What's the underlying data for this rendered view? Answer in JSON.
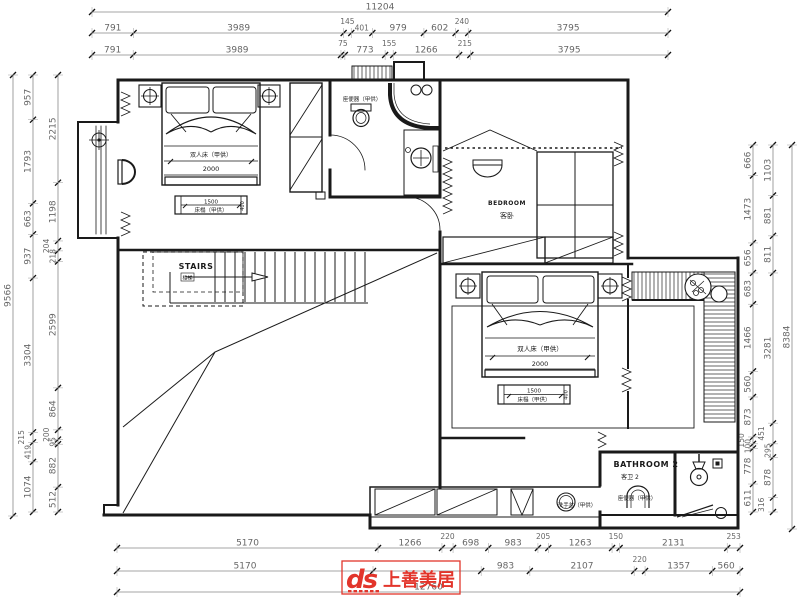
{
  "colors": {
    "logo_red": "#e2352b",
    "ink": "#1a1a1a",
    "dim_text": "#666666"
  },
  "logo": {
    "mark": "ds",
    "brand": "上善美居"
  },
  "labels": {
    "stairs_en": "STAIRS",
    "stairs_cn": "楼梯",
    "bedroom_en": "BEDROOM",
    "bedroom_cn": "客卧",
    "bathroom2_en": "BATHROOM 2",
    "bathroom2_cn": "客卫 2",
    "double_bed": "双人床（甲供）",
    "bed_width": "2000",
    "bench_len": "1500",
    "bench": "床榻（甲供）",
    "bench_depth": "400",
    "toilet": "座便器（甲供）",
    "basin": "洗手盆（甲供）"
  },
  "dims": {
    "top_total": [
      11204
    ],
    "top_row1": [
      791,
      3989,
      145,
      401,
      979,
      602,
      240,
      3795
    ],
    "top_row2": [
      791,
      3989,
      75,
      773,
      155,
      1266,
      215,
      3795
    ],
    "left_total": [
      9566
    ],
    "left_a": [
      957,
      1793,
      663,
      937,
      3304,
      215,
      419,
      1074
    ],
    "left_b": [
      2215,
      1198,
      204,
      218,
      2599,
      864,
      200,
      95,
      882,
      512
    ],
    "right_c": [
      666,
      1473,
      656,
      683,
      1466,
      560,
      873,
      150,
      100,
      778,
      611
    ],
    "right_d": [
      1103,
      881,
      811,
      3281,
      451,
      295,
      878,
      316
    ],
    "right_total": [
      8384
    ],
    "bottom_row1": [
      5170,
      1266,
      220,
      698,
      983,
      205,
      1263,
      150,
      2131,
      253
    ],
    "bottom_row2": [
      5170,
      {
        "v": 2184,
        "t": ""
      },
      983,
      2107,
      220,
      1357,
      560
    ],
    "bottom_total": [
      12760
    ]
  }
}
